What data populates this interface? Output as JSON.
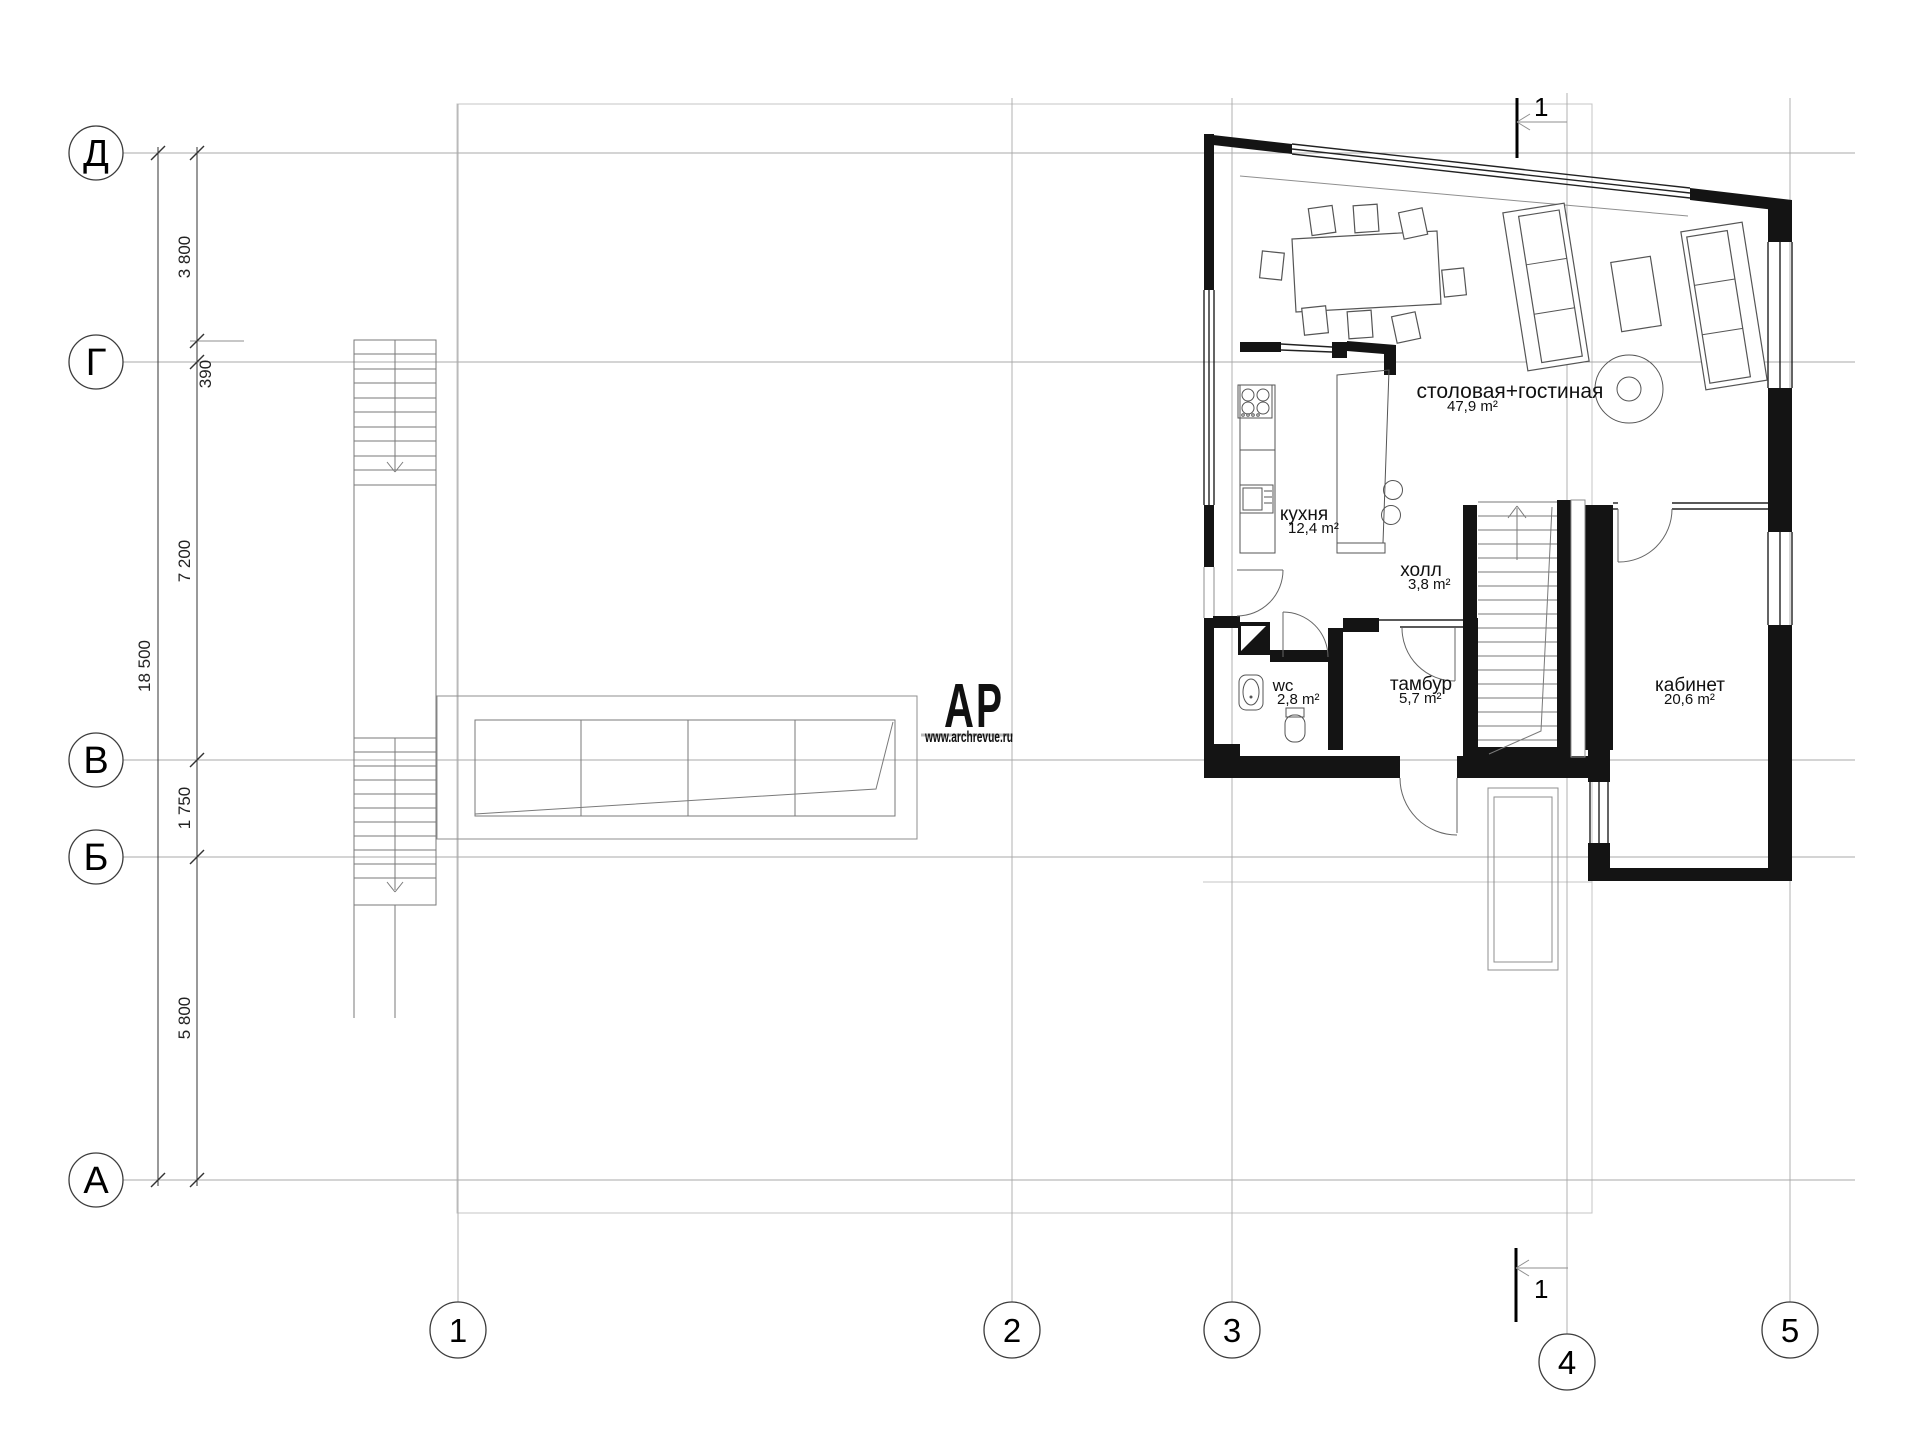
{
  "grid": {
    "row_axes": [
      {
        "label": "Д"
      },
      {
        "label": "Г"
      },
      {
        "label": "В"
      },
      {
        "label": "Б"
      },
      {
        "label": "А"
      }
    ],
    "col_axes": [
      {
        "label": "1"
      },
      {
        "label": "2"
      },
      {
        "label": "3"
      },
      {
        "label": "4"
      },
      {
        "label": "5"
      }
    ]
  },
  "dimensions": {
    "overall": "18 500",
    "d_dg": "3 800",
    "d_offset": "390",
    "d_gv": "7 200",
    "d_vb": "1 750",
    "d_ba": "5 800"
  },
  "rooms": [
    {
      "name": "столовая+гостиная",
      "area": "47,9 m²"
    },
    {
      "name": "кухня",
      "area": "12,4 m²"
    },
    {
      "name": "холл",
      "area": "3,8 m²"
    },
    {
      "name": "wc",
      "area": "2,8 m²"
    },
    {
      "name": "тамбур",
      "area": "5,7 m²"
    },
    {
      "name": "кабинет",
      "area": "20,6 m²"
    }
  ],
  "section_marks": {
    "top": "1",
    "bottom": "1"
  },
  "logo": {
    "letter_a": "А",
    "letter_p": "Р",
    "url": "www.archrevue.ru"
  },
  "colors": {
    "wall": "#141414",
    "grid_line": "#a9a9a9",
    "furniture": "#555555",
    "logo_a": "#9c4b54",
    "logo_p": "#c8c8c8",
    "logo_url": "#8c3f47"
  }
}
